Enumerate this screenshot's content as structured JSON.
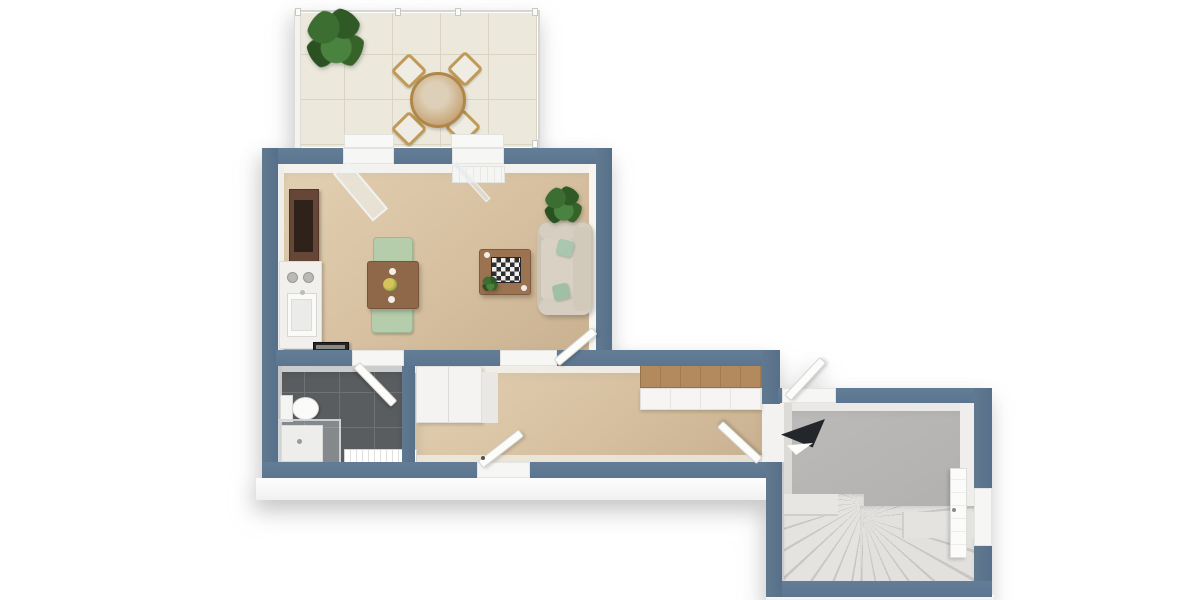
{
  "scene": {
    "description": "Photorealistic 3D top-down (dollhouse) floor plan rendering of a one-level apartment on a plain white background",
    "view": "bird's-eye 3D render, slate-blue wall caps, white wall faces, soft drop shadow under the slab",
    "text_labels": []
  },
  "palette": {
    "background": "#ffffff",
    "exterior_wall_cap": "#5e7791",
    "wall_inner_face": "#f2f1ef",
    "living_hall_floor": "#d6c0a0",
    "bathroom_floor_tile": "#5a5d5f",
    "bathroom_grout": "#6f7274",
    "stair_hall_floor": "#b4b3b1",
    "stair_treads": "#e2e1de",
    "terrace_tile": "#ece8dc",
    "foundation_slab": "#f7f7f6",
    "wood_dark_cabinet": "#654637",
    "wood_dining_table": "#8e6849",
    "wood_coffee_table": "#9b7350",
    "wood_sideboard_top": "#b28a5e",
    "terrace_wood": "#c09a56",
    "sofa_beige": "#cbc3b4",
    "chair_green": "#b5cdab",
    "pillow_green": "#a8c7ae",
    "plant_green": "#3c6e31",
    "appliance_black": "#262522",
    "stair_arrow": "#23262a"
  },
  "rooms": [
    {
      "id": "terrace",
      "label": "terrace",
      "floor": "large light tiles",
      "features": [
        "perimeter railing",
        "potted plant (corner)",
        "round wooden dining table",
        "four wooden chairs with white cushions",
        "two white door/window sills"
      ]
    },
    {
      "id": "living-room",
      "label": "open living room with kitchenette",
      "floor": "beige carpet",
      "features": [
        "dark wood tv cabinet",
        "white kitchen counter with sink and two burners",
        "black stove block",
        "square dining table with two green chairs, two plates and centerpiece",
        "coffee table with chessboard and small plant",
        "beige sofa with two green pillows",
        "potted plant in corner",
        "glazed terrace door standing open",
        "window with white sill block"
      ]
    },
    {
      "id": "bathroom",
      "label": "bathroom",
      "floor": "dark gray tiles",
      "features": [
        "toilet with tank",
        "corner shower with glass enclosure and tray",
        "white radiator",
        "door swinging inward"
      ]
    },
    {
      "id": "hallway",
      "label": "hallway",
      "floor": "beige carpet",
      "features": [
        "white double wardrobe",
        "white sideboard with wooden top",
        "open door to living room",
        "open entrance door in south wall",
        "two open doors toward stair hall"
      ]
    },
    {
      "id": "stair-hall",
      "label": "stair hall",
      "floor": "gray screed",
      "features": [
        "U-shaped winder staircase",
        "dark direction arrow",
        "white exterior door in east wall"
      ]
    }
  ],
  "openings": [
    {
      "wall": "north",
      "type": "glazed-door",
      "to": "terrace"
    },
    {
      "wall": "north",
      "type": "window"
    },
    {
      "wall": "living/hall",
      "type": "door-passage"
    },
    {
      "wall": "bathroom",
      "type": "door"
    },
    {
      "wall": "south",
      "type": "entrance-door"
    },
    {
      "wall": "hall/stair-hall",
      "type": "double-door-passage"
    },
    {
      "wall": "stair-hall-east",
      "type": "exterior-door"
    }
  ]
}
